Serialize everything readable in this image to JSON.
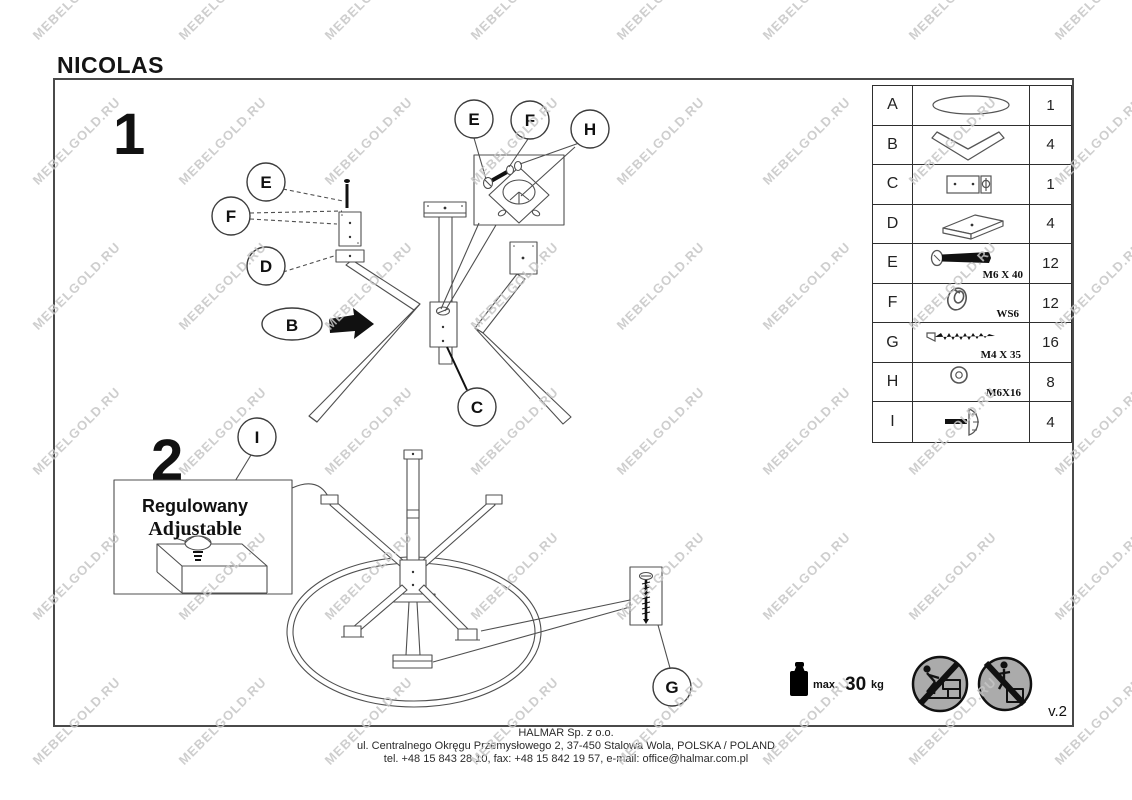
{
  "title": "NICOLAS",
  "steps": {
    "one": "1",
    "two": "2"
  },
  "callout": {
    "polish": "Regulowany",
    "english": "Adjustable"
  },
  "labels": {
    "A": "A",
    "B": "B",
    "C": "C",
    "D": "D",
    "E": "E",
    "F": "F",
    "G": "G",
    "H": "H",
    "I": "I"
  },
  "parts": {
    "rows": [
      {
        "id": "A",
        "icon": "table-top-ellipse",
        "size": "",
        "qty": "1"
      },
      {
        "id": "B",
        "icon": "v-shaped-leg",
        "size": "",
        "qty": "4"
      },
      {
        "id": "C",
        "icon": "center-bracket",
        "size": "",
        "qty": "1"
      },
      {
        "id": "D",
        "icon": "mounting-plate",
        "size": "",
        "qty": "4"
      },
      {
        "id": "E",
        "icon": "bolt",
        "size": "M6 X 40",
        "qty": "12"
      },
      {
        "id": "F",
        "icon": "spring-washer",
        "size": "WS6",
        "qty": "12"
      },
      {
        "id": "G",
        "icon": "wood-screw",
        "size": "M4 X 35",
        "qty": "16"
      },
      {
        "id": "H",
        "icon": "flat-washer",
        "size": "M6X16",
        "qty": "8"
      },
      {
        "id": "I",
        "icon": "adjustable-foot",
        "size": "",
        "qty": "4"
      }
    ]
  },
  "weight_limit": {
    "prefix": "max.",
    "value": "30",
    "unit": "kg"
  },
  "version": "v.2",
  "footer": {
    "company": "HALMAR Sp. z o.o.",
    "address": "ul. Centralnego Okręgu Przemysłowego 2, 37-450 Stalowa Wola, POLSKA / POLAND",
    "contact": "tel. +48 15 843 28 10, fax: +48 15 842 19 57, e-mail: office@halmar.com.pl"
  },
  "watermark": {
    "text": "MEBELGOLD.RU"
  }
}
